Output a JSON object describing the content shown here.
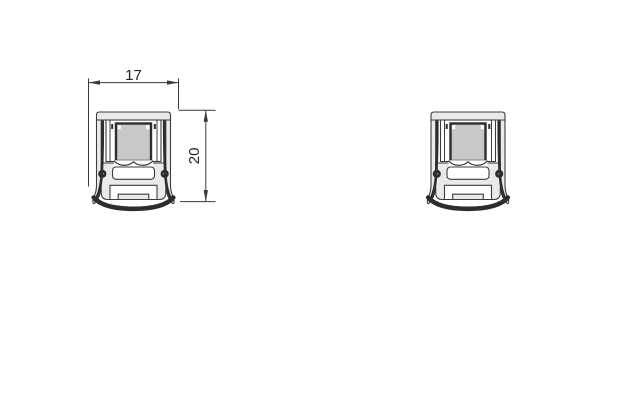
{
  "canvas": {
    "width_px": 627,
    "height_px": 403,
    "background": "#ffffff"
  },
  "drawing": {
    "type": "technical-cross-section",
    "subject": "door-seal-profile",
    "views": [
      {
        "id": "left-profile",
        "dimensioned": true
      },
      {
        "id": "right-profile",
        "dimensioned": false
      }
    ],
    "dimensions": [
      {
        "label": "17",
        "orientation": "horizontal"
      },
      {
        "label": "20",
        "orientation": "vertical"
      }
    ],
    "colors": {
      "outline": "#3c3c3c",
      "dark_detail": "#2d2d2d",
      "aluminium_fill": "#eaeaea",
      "magnet_fill": "#c8c8c8",
      "cutout_fill": "#ffffff",
      "dimension_line": "#3a3a3a",
      "text": "#222222"
    }
  }
}
